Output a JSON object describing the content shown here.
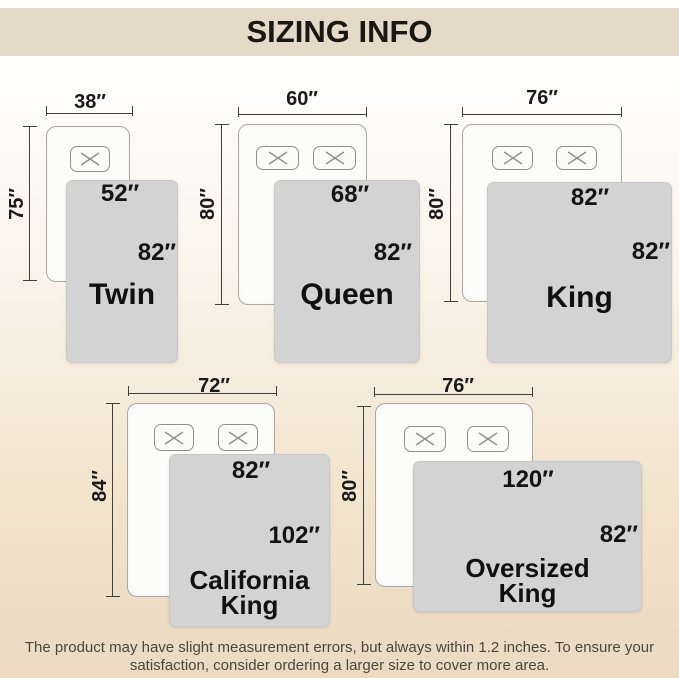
{
  "title": "SIZING INFO",
  "footer": {
    "line1": "The product may have slight measurement errors, but always within 1.2 inches. To ensure your",
    "line2": "satisfaction, consider ordering a larger size to cover more area."
  },
  "sizes": [
    {
      "id": "twin",
      "name": "Twin",
      "name_lines": [
        "Twin",
        ""
      ],
      "mattress_width": "38″",
      "mattress_length": "75″",
      "blanket_width": "52″",
      "blanket_length": "82″"
    },
    {
      "id": "queen",
      "name": "Queen",
      "name_lines": [
        "Queen",
        ""
      ],
      "mattress_width": "60″",
      "mattress_length": "80″",
      "blanket_width": "68″",
      "blanket_length": "82″"
    },
    {
      "id": "king",
      "name": "King",
      "name_lines": [
        "King",
        ""
      ],
      "mattress_width": "76″",
      "mattress_length": "80″",
      "blanket_width": "82″",
      "blanket_length": "82″"
    },
    {
      "id": "california-king",
      "name": "California King",
      "name_lines": [
        "California",
        "King"
      ],
      "mattress_width": "72″",
      "mattress_length": "84″",
      "blanket_width": "82″",
      "blanket_length": "102″"
    },
    {
      "id": "oversized-king",
      "name": "Oversized King",
      "name_lines": [
        "Oversized",
        "King"
      ],
      "mattress_width": "76″",
      "mattress_length": "80″",
      "blanket_width": "120″",
      "blanket_length": "82″"
    }
  ],
  "colors": {
    "title_band": "#e5dac8",
    "background_bottom": "#ecdac3",
    "blanket_fill": "#d3d3d3",
    "mattress_fill": "#fcfcfa",
    "dimension_line": "#3f3f3f"
  }
}
